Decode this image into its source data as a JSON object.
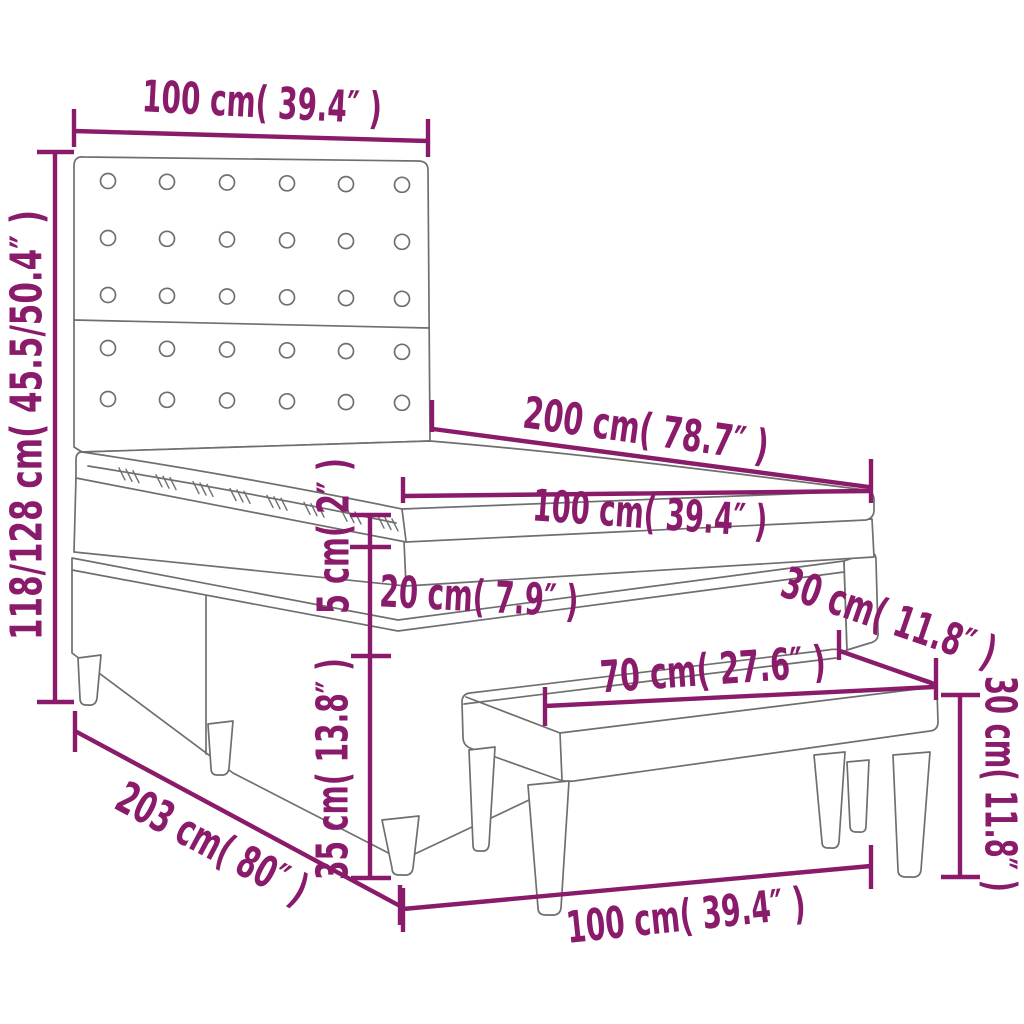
{
  "diagram": {
    "title": "Box spring bed with tufted headboard, topper and bench - dimension diagram",
    "colors": {
      "dimension_accent": "#8a1b6b",
      "drawing_outline": "#6f6f6f",
      "background": "#ffffff"
    },
    "illustration": {
      "headboard_buttons": {
        "columns": 6,
        "rows_upper": 3,
        "rows_lower": 2
      }
    }
  },
  "labels": {
    "headboard_width": "100 cm( 39.4″ )",
    "headboard_height": "118/128 cm( 45.5/50.4″ )",
    "bed_length": "200 cm( 78.7″ )",
    "mattress_width": "100 cm( 39.4″ )",
    "topper_thickness": "5 cm( 2″ )",
    "mattress_thickness": "20 cm( 7.9″ )",
    "base_height": "35 cm( 13.8″ )",
    "bed_total_length": "203 cm( 80″ )",
    "bench_length": "70 cm( 27.6″ )",
    "bench_depth": "30 cm( 11.8″ )",
    "bench_height": "30 cm( 11.8″ )",
    "bench_width": "100 cm( 39.4″ )"
  }
}
